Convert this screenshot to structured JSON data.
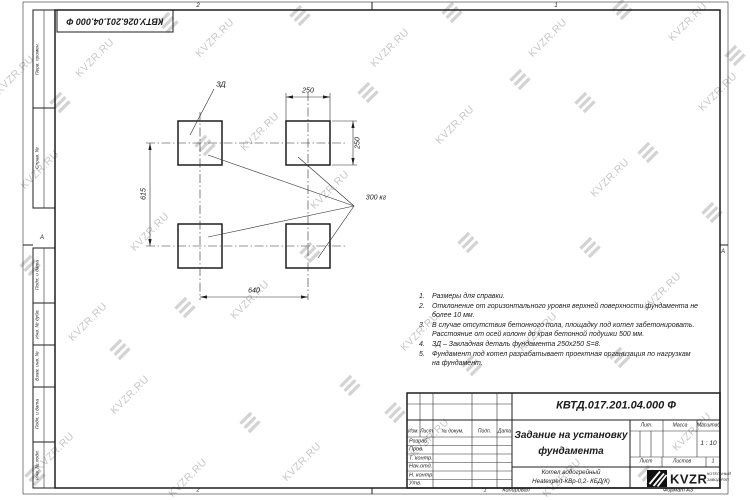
{
  "watermark": {
    "text": "KVZR.RU"
  },
  "top_margin": {
    "doc_number_rotated": "КВТУ.026.201.04.000 Ф",
    "zone_left": "2",
    "zone_right": "1"
  },
  "side_zones": {
    "left": "А",
    "right": "А"
  },
  "margin_fields": [
    "Перв. примен.",
    "Справ. №",
    "Подп. и дата",
    "Инв. № дубл.",
    "Взам. инв. №",
    "Подп. и дата",
    "Инв. № подл."
  ],
  "drawing": {
    "embed_label": "ЗД",
    "load_label": "300 кг",
    "dim_top": "250",
    "dim_right": "250",
    "dim_left": "615",
    "dim_bottom": "640"
  },
  "notes": [
    {
      "num": "1.",
      "text": "Размеры для справки."
    },
    {
      "num": "2.",
      "text": "Отклонение от горизонтального уровня верхней поверхности фундамента не более 10 мм."
    },
    {
      "num": "3.",
      "text": "В случае отсутствия бетонного пола, площадку под котел забетонировать. Расстояние от осей колонн до края бетонной подушки 500 мм."
    },
    {
      "num": "4.",
      "text": "ЗД – Закладная деталь фундамента 250х250 S=8."
    },
    {
      "num": "5.",
      "text": "Фундамент под котел разрабатывает проектная организация по нагрузкам на фундамент."
    }
  ],
  "title_block": {
    "doc_number": "КВТД.017.201.04.000 Ф",
    "title_line1": "Задание на установку",
    "title_line2": "фундамента",
    "product_line1": "Котел водогрейный",
    "product_line2": "Heatexpert-КВр-0,2- КБД(К)",
    "col_izm": "Изм.",
    "col_list": "Лист",
    "col_doc": "№ докум.",
    "col_podp": "Подп.",
    "col_data": "Дата",
    "row_razrab": "Разраб.",
    "row_prov": "Пров.",
    "row_tkontr": "Т. контр.",
    "row_nachotd": "Нач.отд.",
    "row_nkontr": "Н. контр.",
    "row_utv": "Утв.",
    "lit_label": "Лит.",
    "mass_label": "Масса",
    "scale_label": "Масштаб",
    "scale_value": "1 : 10",
    "sheet_label": "Лист",
    "sheets_label": "Листов",
    "sheets_value": "1",
    "logo_text": "KVZR",
    "logo_sub_line1": "КОТЕЛЬНЫЙ",
    "logo_sub_line2": "ЗАВОД РЭП"
  },
  "footer": {
    "zone2": "2",
    "zone1": "1",
    "copied_label": "Копировал",
    "format_label": "Формат А3"
  }
}
